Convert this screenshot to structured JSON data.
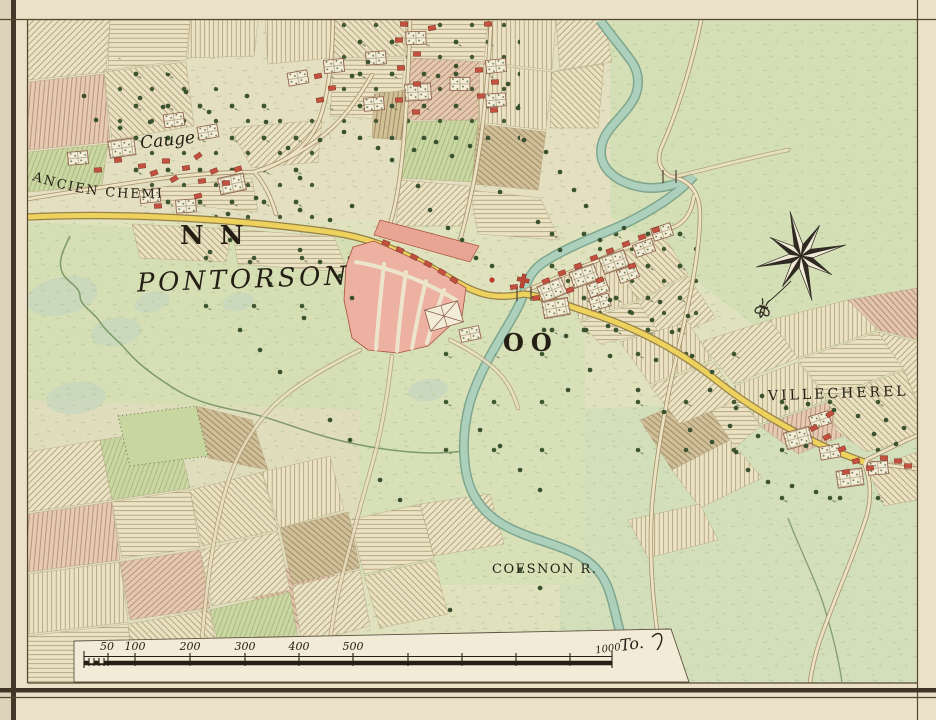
{
  "map": {
    "title_region": "Pontorson manuscript map",
    "labels": {
      "hamlet_cauge": "Cauge",
      "ancien_chemin": "ANCIEN CHEMIN",
      "ref_nn": "NN",
      "town_pontorson": "PONTORSON",
      "ref_oo": "OO",
      "villecherel": "VILLECHEREL",
      "coesnon_river": "COESNON R."
    },
    "scale_bar": {
      "ticks": [
        "50",
        "100",
        "200",
        "300",
        "400",
        "500"
      ],
      "end_value": "1000",
      "end_unit": "To."
    },
    "compass_rose": {
      "type": "eight-point-star",
      "pendant": "fleur-de-lis"
    },
    "colors": {
      "paper": "#eae1c8",
      "map_base": "#dfe2bd",
      "meadow_green": "#d5dfb6",
      "river_teal": "#acd0bc",
      "road_yellow": "#edd35e",
      "town_pink": "#edb1a1",
      "building_red": "#c4503f",
      "ink": "#241e14"
    }
  }
}
